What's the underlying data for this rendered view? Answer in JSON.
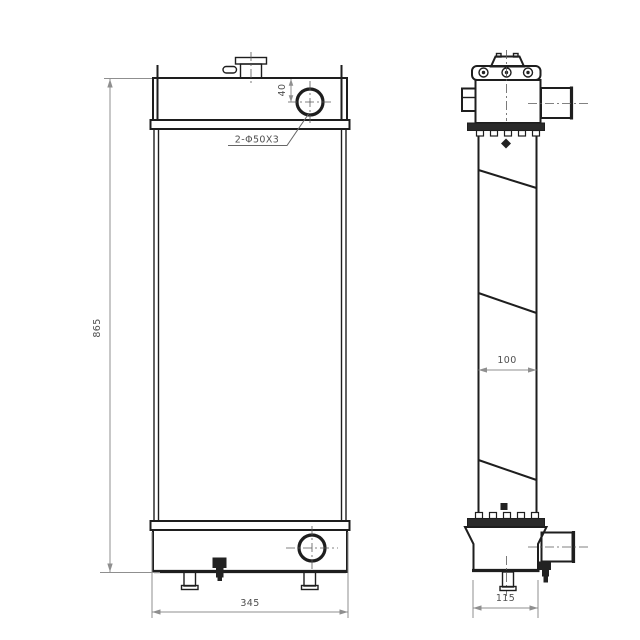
{
  "drawing": {
    "type": "radiator-two-view-engineering-drawing",
    "colors": {
      "background": "#ffffff",
      "part_line": "#1e1e1e",
      "dimension_line": "#8f8f8f",
      "text": "#4f4f4f"
    },
    "dims": {
      "overall_height": "865",
      "overall_width": "345",
      "inlet_port_offset": "40",
      "ports_label": "2-Φ50X3",
      "core_thickness": "100",
      "side_tank_width": "115"
    }
  }
}
